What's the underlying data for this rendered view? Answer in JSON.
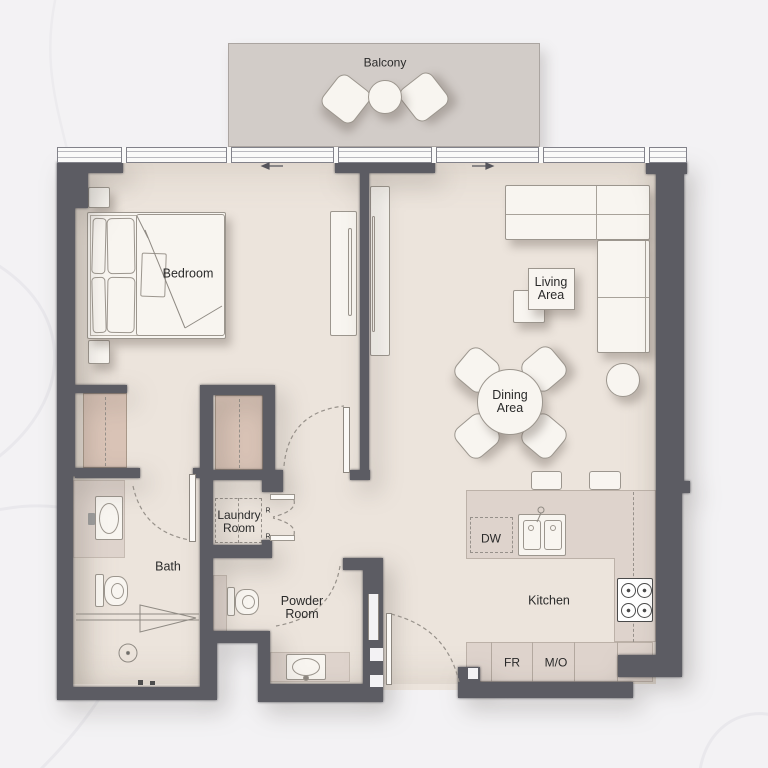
{
  "rooms": {
    "balcony": {
      "label": "Balcony"
    },
    "bedroom": {
      "label": "Bedroom"
    },
    "living_area": {
      "line1": "Living",
      "line2": "Area"
    },
    "dining_area": {
      "line1": "Dining",
      "line2": "Area"
    },
    "laundry_room": {
      "line1": "Laundry",
      "line2": "Room"
    },
    "bath": {
      "label": "Bath"
    },
    "powder_room": {
      "line1": "Powder",
      "line2": "Room"
    },
    "kitchen": {
      "label": "Kitchen"
    }
  },
  "appliances": {
    "dishwasher": "DW",
    "fridge": "FR",
    "microwave_oven": "M/O",
    "laundry_mark_left": "R",
    "laundry_mark_right": "R"
  },
  "colors": {
    "wall": "#5c5c63",
    "floor": "#ece4dc",
    "balcony": "#d2ccc8",
    "closet": "#d9c3b6",
    "counter": "#ded3cc",
    "furniture": "#f8f5f0",
    "furniture_outline": "#9c968e",
    "text": "#2a2a2a",
    "background": "#f3f2f4"
  }
}
